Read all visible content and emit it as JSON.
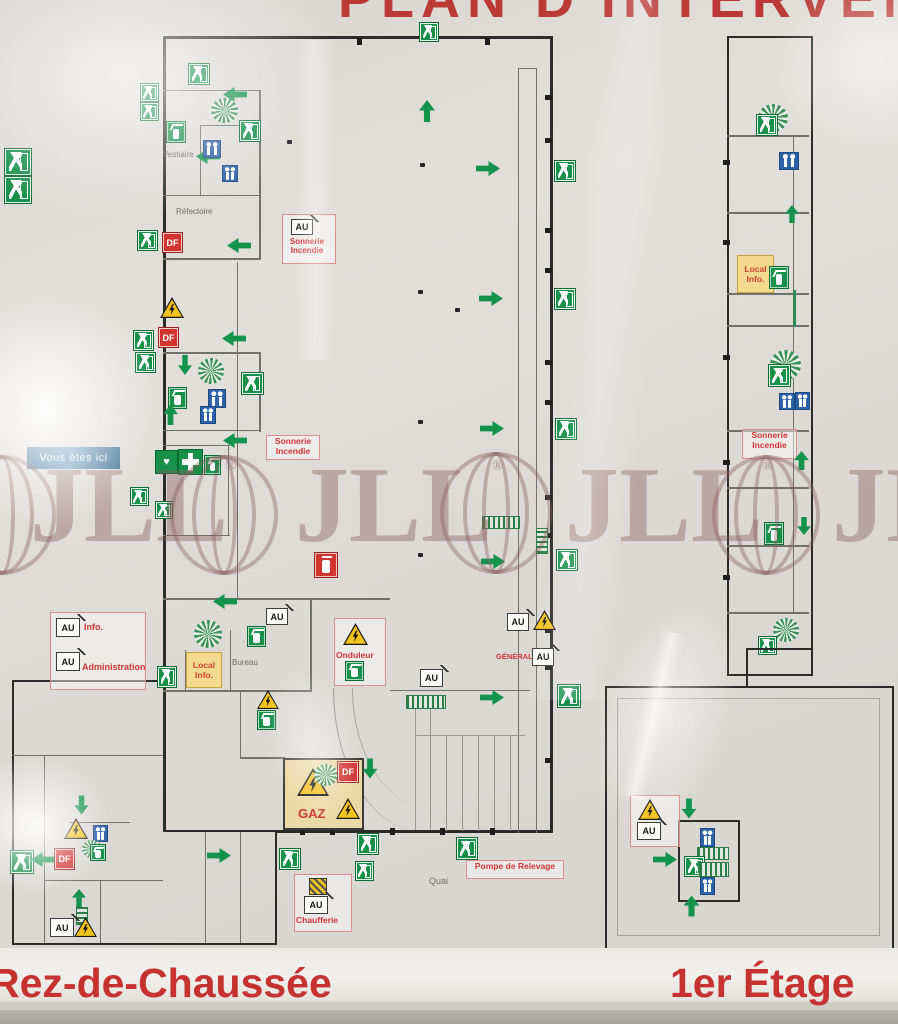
{
  "title": "PLAN D'INTERVENTION",
  "watermark": {
    "text": "JLL",
    "registered": "®"
  },
  "floor_labels": {
    "ground": "Rez-de-Chaussée",
    "first": "1er Étage"
  },
  "you_are_here": "Vous êtes ici",
  "rooms": {
    "vestiaire": "Vestiaire",
    "refectoire": "Réfectoire",
    "bureau": "Bureau",
    "quai": "Quai"
  },
  "labels": {
    "sonnerie_incendie": "Sonnerie Incendie",
    "onduleur": "Onduleur",
    "pompe_de_relevage": "Pompe de Relevage",
    "chaufferie": "Chaufferie",
    "local_info": "Local Info.",
    "gaz": "GAZ",
    "general": "GÉNÉRAL",
    "info": "Info.",
    "administration": "Administration"
  },
  "badges": {
    "au": "AU",
    "df": "DF"
  },
  "icons": {
    "exit": "running-man-exit-sign",
    "arrow": "evacuation-direction-arrow",
    "extinguisher": "fire-extinguisher",
    "fire_equipment_red": "fire-extinguisher-red-box",
    "first_aid": "first-aid-cross",
    "aed": "heart-aed",
    "wc": "restroom-figures",
    "spiral_stairs": "spiral-staircase",
    "stairs": "staircase-hatched",
    "warning_electric": "electric-hazard-triangle",
    "warning_gas": "gas-hazard-triangle",
    "valve": "shutoff-valve-hatched-square"
  },
  "colors": {
    "safety_green": "#17904a",
    "alarm_red": "#d23430",
    "warning_yellow": "#f2c21d",
    "wc_blue": "#2f63a8",
    "wall_dark": "#2b2b29",
    "title_red": "#bb3a35",
    "floor_label_red": "#c53230",
    "watermark_maroon": "#8d5f5f",
    "marker_blue": "#4d7fa3"
  }
}
